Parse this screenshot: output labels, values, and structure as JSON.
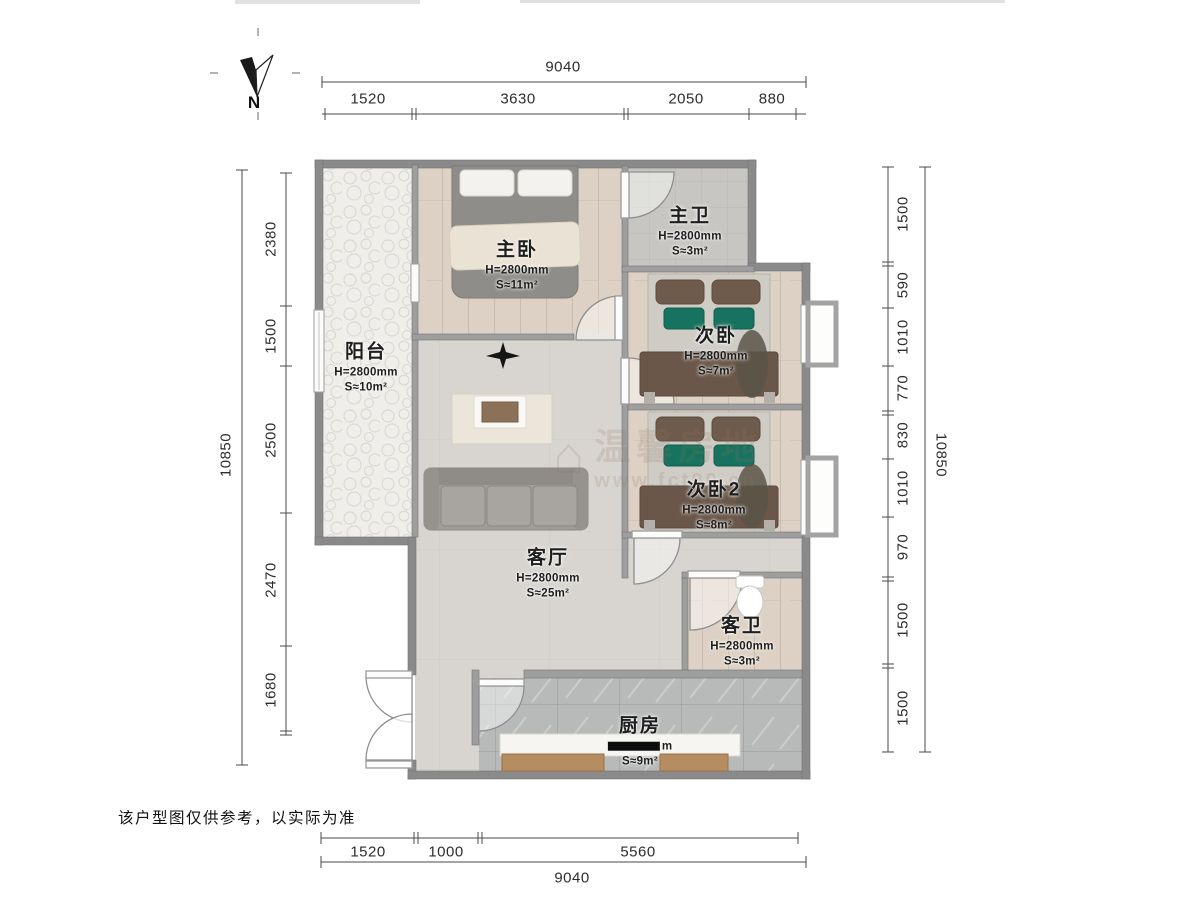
{
  "compass": {
    "label": "N"
  },
  "disclaimer": "该户型图仅供参考，以实际为准",
  "watermark": {
    "brand": "温馨房地",
    "url": "www.fct00.cn",
    "icon": "house-icon"
  },
  "rooms": {
    "balcony": {
      "name": "阳台",
      "height": "H=2800mm",
      "area": "S≈10m²"
    },
    "master_bedroom": {
      "name": "主卧",
      "height": "H=2800mm",
      "area": "S≈11m²"
    },
    "master_bath": {
      "name": "主卫",
      "height": "H=2800mm",
      "area": "S≈3m²"
    },
    "bedroom2": {
      "name": "次卧",
      "height": "H=2800mm",
      "area": "S≈7m²"
    },
    "bedroom2b": {
      "name": "次卧2",
      "height": "H=2800mm",
      "area": "S≈8m²"
    },
    "living": {
      "name": "客厅",
      "height": "H=2800mm",
      "area": "S≈25m²"
    },
    "guest_bath": {
      "name": "客卫",
      "height": "H=2800mm",
      "area": "S≈3m²"
    },
    "kitchen": {
      "name": "厨房",
      "height_visible": "m",
      "area": "S≈9m²"
    }
  },
  "dims": {
    "top": {
      "total": "9040",
      "segments": [
        "1520",
        "3630",
        "2050",
        "880"
      ]
    },
    "bottom": {
      "total": "9040",
      "segments": [
        "1520",
        "1000",
        "5560"
      ]
    },
    "left": {
      "total": "10850",
      "segments": [
        "2380",
        "1500",
        "2500",
        "2470",
        "1680"
      ]
    },
    "right": {
      "total": "10850",
      "segments": [
        "1500",
        "590",
        "1010",
        "770",
        "830",
        "1010",
        "970",
        "1500",
        "1500"
      ]
    }
  },
  "palette": {
    "wall": "#8a8a8a",
    "wood_floor": "#dcd1c4",
    "tile_floor": "#c7c6c2",
    "kitchen_tile": "#b7bab9",
    "living_floor": "#d8d5d0",
    "cabinet_wood": "#b68d61",
    "cushion_green": "#17735f",
    "blanket_brown": "#6a5749"
  }
}
